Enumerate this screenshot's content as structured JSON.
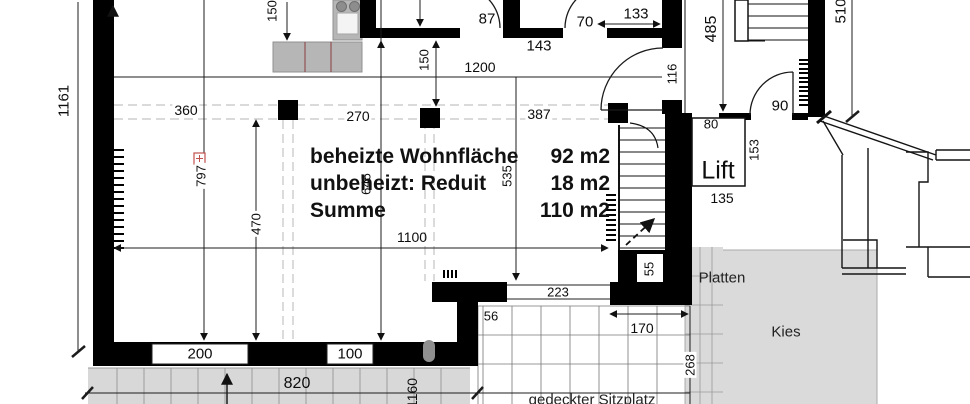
{
  "summary": {
    "rows": [
      {
        "label": "beheizte Wohnfläche",
        "value": "92 m2"
      },
      {
        "label": "unbeheizt: Reduit",
        "value": "18 m2"
      },
      {
        "label": "Summe",
        "value": "110 m2"
      }
    ]
  },
  "rooms": {
    "lift": "Lift"
  },
  "areas": {
    "platten": "Platten",
    "kies": "Kies",
    "sitzplatz": "gedeckter Sitzplatz"
  },
  "dims": {
    "total_height": "1161",
    "kitchen_offset_150": "150",
    "grid_150": "150",
    "top_width_1200": "1200",
    "door_87": "87",
    "wall_143": "143",
    "door_70": "70",
    "top_133": "133",
    "corridor_485": "485",
    "right_510": "510",
    "opening_116": "116",
    "bay_360": "360",
    "bay_270": "270",
    "bay_387": "387",
    "line_797": "797",
    "room_1100": "1100",
    "room_470": "470",
    "room_645": "645",
    "room_535": "535",
    "door_90": "90",
    "door_80": "80",
    "lift_153": "153",
    "lift_135": "135",
    "stair_55": "55",
    "window_223": "223",
    "offset_56": "56",
    "terrace_170": "170",
    "terrace_268": "268",
    "window_200": "200",
    "window_100": "100",
    "terrace_820": "820",
    "terrace_1160": "1160"
  }
}
